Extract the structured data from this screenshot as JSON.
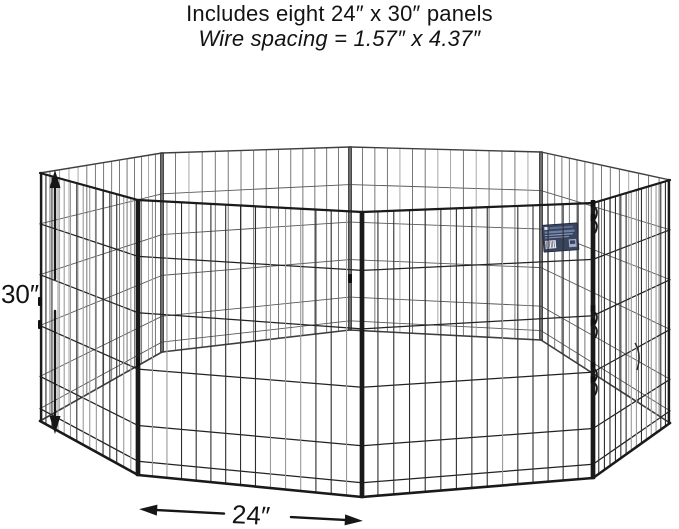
{
  "page": {
    "background": "#ffffff"
  },
  "header": {
    "line1": "Includes eight 24″ x 30″ panels",
    "line2": "Wire spacing = 1.57″ x 4.37″"
  },
  "dimension_annotations": {
    "height": {
      "label": "30″"
    },
    "width": {
      "label": "24″"
    }
  },
  "illustration": {
    "type": "octagonal-wire-exercise-pen",
    "panel_count": 8,
    "verticals_per_panel": 14,
    "h_rows": [
      0.205,
      0.41,
      0.615,
      0.82,
      0.95
    ],
    "posts": [
      {
        "x": 362,
        "yt": 212,
        "yb": 497
      },
      {
        "x": 593,
        "yt": 203,
        "yb": 478
      },
      {
        "x": 670,
        "yt": 180,
        "yb": 423
      },
      {
        "x": 541,
        "yt": 152,
        "yb": 340
      },
      {
        "x": 350,
        "yt": 147,
        "yb": 330
      },
      {
        "x": 162,
        "yt": 153,
        "yb": 352
      },
      {
        "x": 40,
        "yt": 173,
        "yb": 421
      },
      {
        "x": 138,
        "yt": 200,
        "yb": 475
      }
    ],
    "far_panels": [
      [
        2,
        3
      ],
      [
        3,
        4
      ],
      [
        4,
        5
      ],
      [
        5,
        6
      ]
    ],
    "near_panels": [
      [
        6,
        7
      ],
      [
        7,
        0
      ],
      [
        0,
        1
      ],
      [
        1,
        2
      ]
    ],
    "colors": {
      "frame_near": "#1a1a1a",
      "frame_far": "#3e3e3e",
      "wire_near": "#2e2e2e",
      "wire_far": "#606060",
      "h_near": "#222222",
      "h_far": "#585858",
      "glare": "#9a9a9a",
      "hardware": "#101010",
      "arrow": "#161616"
    },
    "latches": {
      "x": 593,
      "ys": [
        206,
        311,
        368
      ]
    },
    "tabs": [
      {
        "post": 6,
        "y": 297
      },
      {
        "post": 6,
        "y": 320
      },
      {
        "post": 7,
        "y": 358
      },
      {
        "post": 4,
        "y": 274
      }
    ],
    "door_hook_path": "M635 343 q7 11 2 27",
    "label_tag": {
      "x": 543,
      "y": 224,
      "w": 35,
      "h": 27,
      "rotate": -4,
      "bg": "#39445f",
      "border": "#1c2538",
      "band": "#6d80a8",
      "title_band": "#5d6f95",
      "logo": "#dde3f0",
      "text_line1": "#94a2c2",
      "text_line2": "#8391b5",
      "barcode_bg": "#edf0f6",
      "barcode_bars": "#222b44",
      "badge": "#9fadca"
    },
    "height_arrow": {
      "x": 55,
      "y1": 170,
      "y2": 434,
      "gap_top": 279,
      "gap_bottom": 311
    },
    "width_arrow": {
      "x1": 139,
      "x2": 363,
      "y": 515,
      "tilt": 3,
      "gap_left": 224,
      "gap_right": 291
    }
  }
}
